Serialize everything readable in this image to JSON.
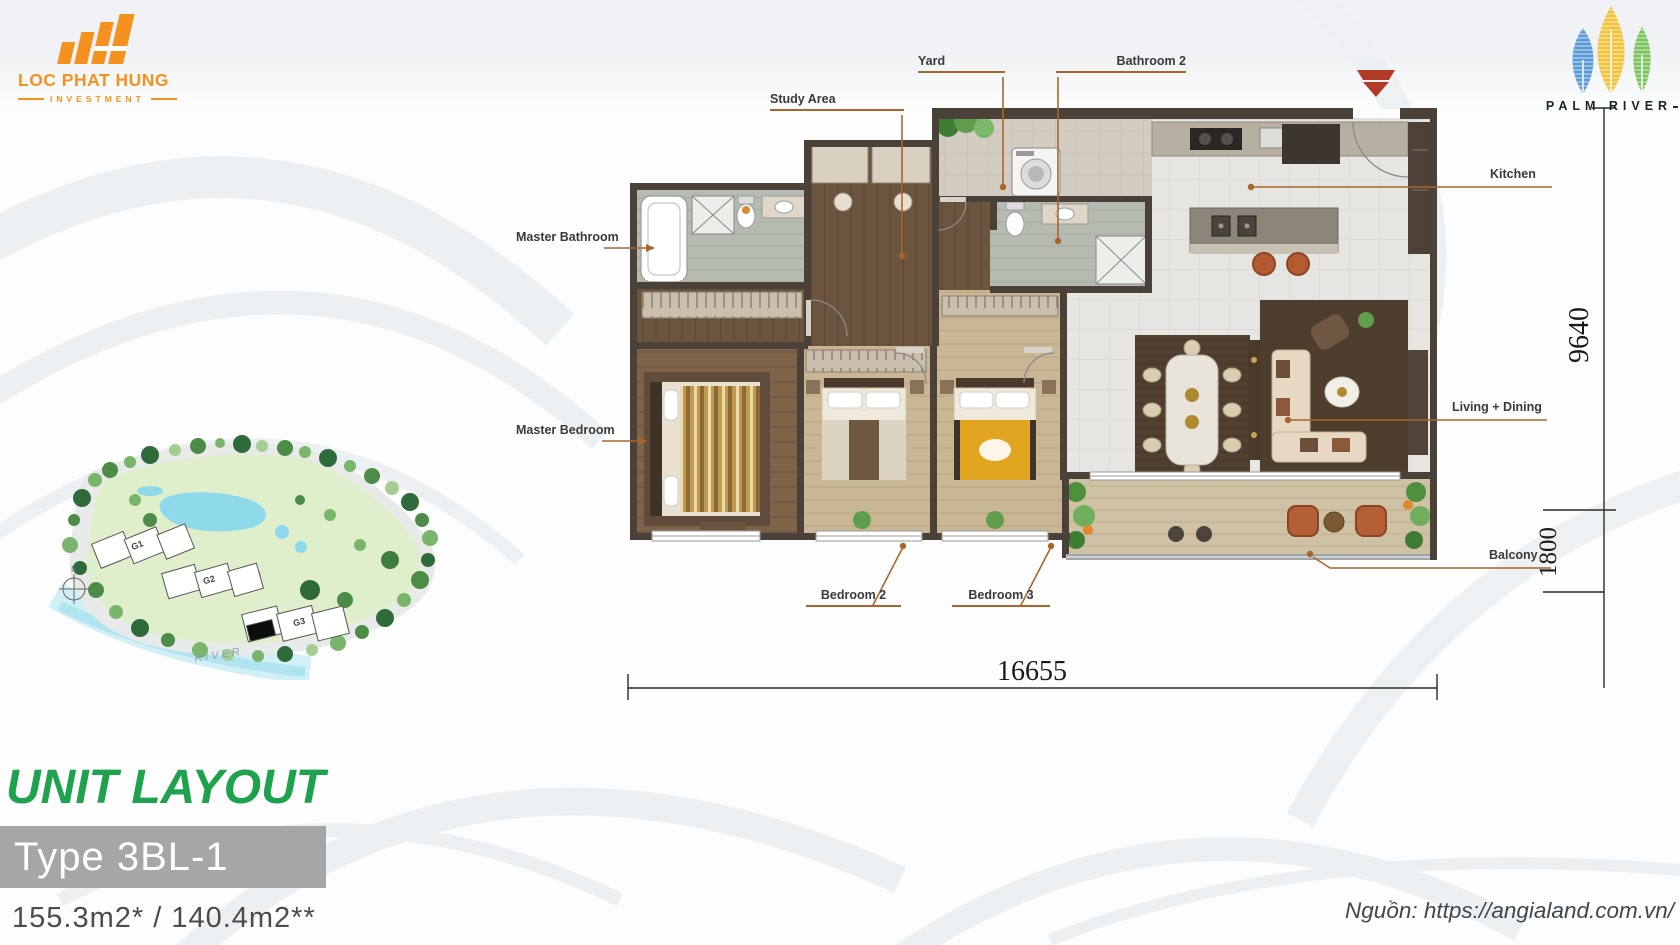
{
  "header": {
    "developer_logo": {
      "name": "LOC PHAT HUNG",
      "subtitle": "INVESTMENT"
    },
    "project_logo": {
      "name": "PALM RIVER"
    }
  },
  "floorplan": {
    "room_labels": {
      "yard": "Yard",
      "bathroom2": "Bathroom 2",
      "study_area": "Study Area",
      "master_bathroom": "Master Bathroom",
      "master_bedroom": "Master Bedroom",
      "bedroom2": "Bedroom 2",
      "bedroom3": "Bedroom 3",
      "kitchen": "Kitchen",
      "living_dining": "Living + Dining",
      "balcony": "Balcony"
    },
    "dimensions": {
      "width": "16655",
      "depth": "9640",
      "balcony_depth": "1800"
    }
  },
  "siteplan": {
    "buildings": [
      "G1",
      "G2",
      "G3"
    ],
    "river": "RIVER",
    "compass": "N"
  },
  "footer": {
    "title": "UNIT LAYOUT",
    "unit_type": "Type 3BL-1",
    "area": "155.3m2* / 140.4m2**",
    "source": "Nguồn: https://angialand.com.vn/"
  },
  "colors": {
    "accent_orange": "#F5921F",
    "title_green": "#1FA24E",
    "leader_line": "#A9662C",
    "type_bar": "#A6A6A6",
    "wall": "#4A4238"
  }
}
